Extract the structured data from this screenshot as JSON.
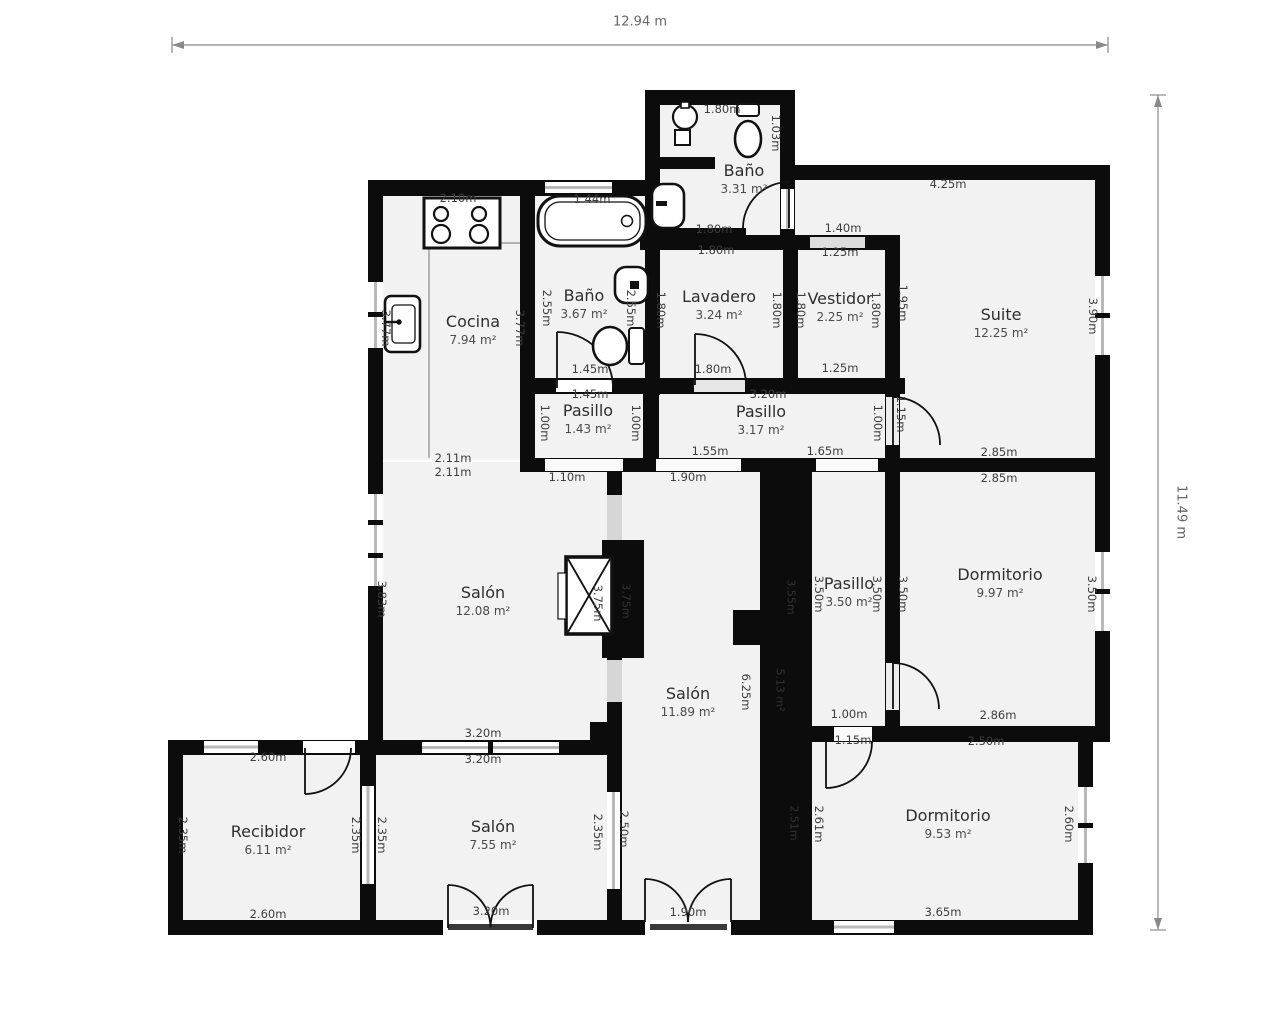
{
  "overall": {
    "width_label": "12.94 m",
    "height_label": "11.49 m"
  },
  "rooms": [
    {
      "name": "Cocina",
      "area": "7.94 m²"
    },
    {
      "name": "Baño",
      "area": "3.67 m²"
    },
    {
      "name": "Baño",
      "area": "3.31 m²"
    },
    {
      "name": "Lavadero",
      "area": "3.24 m²"
    },
    {
      "name": "Vestidor",
      "area": "2.25 m²"
    },
    {
      "name": "Suite",
      "area": "12.25 m²"
    },
    {
      "name": "Pasillo",
      "area": "1.43 m²"
    },
    {
      "name": "Pasillo",
      "area": "3.17 m²"
    },
    {
      "name": "Salón",
      "area": "12.08 m²"
    },
    {
      "name": "Salón",
      "area": "11.89 m²"
    },
    {
      "name": "Pasillo",
      "area": "3.50 m²"
    },
    {
      "name": "Dormitorio",
      "area": "9.97 m²"
    },
    {
      "name": "Recibidor",
      "area": "6.11 m²"
    },
    {
      "name": "Salón",
      "area": "7.55 m²"
    },
    {
      "name": "Dormitorio",
      "area": "9.53 m²"
    }
  ],
  "dims": [
    {
      "t": "1.80m"
    },
    {
      "t": "1.03m"
    },
    {
      "t": "1.80m"
    },
    {
      "t": "1.80m"
    },
    {
      "t": "2.10m"
    },
    {
      "t": "1.44m"
    },
    {
      "t": "3.77m"
    },
    {
      "t": "3.77m"
    },
    {
      "t": "2.55m"
    },
    {
      "t": "2.55m"
    },
    {
      "t": "1.45m"
    },
    {
      "t": "1.45m"
    },
    {
      "t": "1.80m"
    },
    {
      "t": "1.80m"
    },
    {
      "t": "1.80m"
    },
    {
      "t": "1.40m"
    },
    {
      "t": "1.25m"
    },
    {
      "t": "1.80m"
    },
    {
      "t": "1.80m"
    },
    {
      "t": "1.25m"
    },
    {
      "t": "1.95m"
    },
    {
      "t": "4.25m"
    },
    {
      "t": "3.90m"
    },
    {
      "t": "1.15m"
    },
    {
      "t": "2.85m"
    },
    {
      "t": "2.85m"
    },
    {
      "t": "3.20m"
    },
    {
      "t": "1.00m"
    },
    {
      "t": "1.00m"
    },
    {
      "t": "1.00m"
    },
    {
      "t": "1.55m"
    },
    {
      "t": "1.65m"
    },
    {
      "t": "1.10m"
    },
    {
      "t": "1.90m"
    },
    {
      "t": "2.11m"
    },
    {
      "t": "2.11m"
    },
    {
      "t": "3.83m"
    },
    {
      "t": "3.75m"
    },
    {
      "t": "3.20m"
    },
    {
      "t": "3.20m"
    },
    {
      "t": "6.25m"
    },
    {
      "t": "3.50m"
    },
    {
      "t": "3.50m"
    },
    {
      "t": "3.50m"
    },
    {
      "t": "3.50m"
    },
    {
      "t": "2.86m"
    },
    {
      "t": "1.00m"
    },
    {
      "t": "1.15m"
    },
    {
      "t": "2.50m"
    },
    {
      "t": "2.60m"
    },
    {
      "t": "2.35m"
    },
    {
      "t": "2.35m"
    },
    {
      "t": "2.35m"
    },
    {
      "t": "2.60m"
    },
    {
      "t": "2.35m"
    },
    {
      "t": "2.50m"
    },
    {
      "t": "3.20m"
    },
    {
      "t": "1.90m"
    },
    {
      "t": "2.61m"
    },
    {
      "t": "2.60m"
    },
    {
      "t": "3.65m"
    }
  ],
  "shaft_annotations": [
    {
      "t": "3.55m"
    },
    {
      "t": "5.13 m²"
    },
    {
      "t": "2.51m"
    },
    {
      "t": "3.75m"
    }
  ],
  "colors": {
    "wall": "#0c0c0c",
    "room_fill": "#f2f2f2",
    "dim_text": "#3d3d3d",
    "overall_text": "#666666",
    "window": "#b9b9b9",
    "threshold": "#dddddd"
  }
}
